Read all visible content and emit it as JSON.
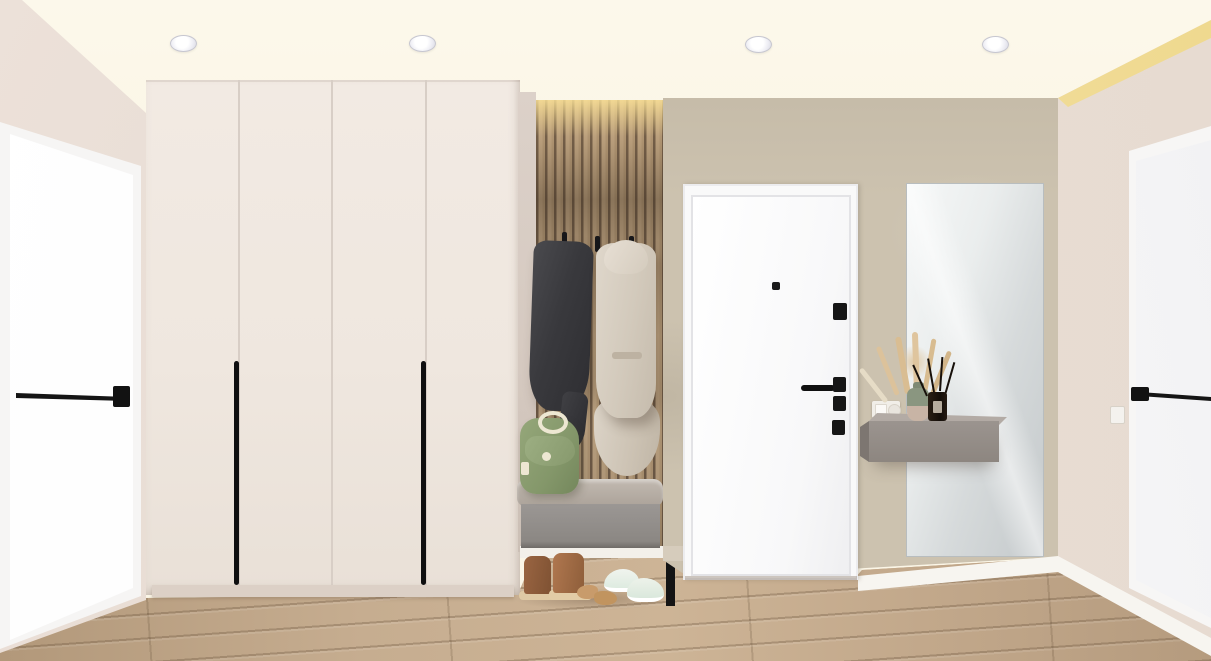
{
  "scene": {
    "type": "3d-interior-render",
    "room": "entryway hallway",
    "visible_text": "none",
    "palette": {
      "ceiling": "#FBF6E7",
      "side_walls": "#E8DDD5",
      "accent_wall": "#CCC2AF",
      "wardrobe": "#EFE7DF",
      "wood_slats_light": "#C2A886",
      "wood_slats_dark": "#6E5B48",
      "floor_wood": "#C2A98C",
      "doors_white": "#FAFAFB",
      "hardware_black": "#161616",
      "bench_gray": "#8F8B87",
      "console_taupe": "#948D87",
      "backpack_green": "#8CA173",
      "coat_dark": "#3B3B3E",
      "coat_beige": "#D5CCBF",
      "mirror_glass": "#D9DDDE",
      "cove_glow": "#EFD98F"
    },
    "objects": [
      {
        "id": "ceiling",
        "label": "cream ceiling with four recessed round spotlights"
      },
      {
        "id": "left-door",
        "label": "white interior door with black bar handle on left wall"
      },
      {
        "id": "wardrobe",
        "label": "four-panel floor-to-ceiling wardrobe with two long black pull handles"
      },
      {
        "id": "slat-wall",
        "label": "vertical wood slat accent panel with three black coat hooks"
      },
      {
        "id": "coat-dark",
        "label": "charcoal coat hanging on hook"
      },
      {
        "id": "coat-beige",
        "label": "long beige coat hanging on hook"
      },
      {
        "id": "backpack",
        "label": "sage green backpack resting on bench cushion"
      },
      {
        "id": "bench",
        "label": "floating gray bench with upholstered cushion and black leg"
      },
      {
        "id": "shoes",
        "label": "brown boots, tan slippers and white sneakers on floor"
      },
      {
        "id": "entry-door",
        "label": "white entry door with black peephole, locks and lever handle"
      },
      {
        "id": "switch",
        "label": "white light switch and power socket beside entry door"
      },
      {
        "id": "mirror",
        "label": "tall frameless wall mirror"
      },
      {
        "id": "console",
        "label": "floating taupe console shelf"
      },
      {
        "id": "vase",
        "label": "two-tone green and beige vase with dried pampas grass"
      },
      {
        "id": "diffuser",
        "label": "dark reed diffuser bottle with black sticks"
      },
      {
        "id": "right-door",
        "label": "white interior door with black bar handle on right wall"
      },
      {
        "id": "floor",
        "label": "light oak plank flooring"
      }
    ],
    "lighting": {
      "recessed_lights_count": 4,
      "cove_glow_right_corner": true,
      "slat_panel_top_glow": true
    }
  }
}
